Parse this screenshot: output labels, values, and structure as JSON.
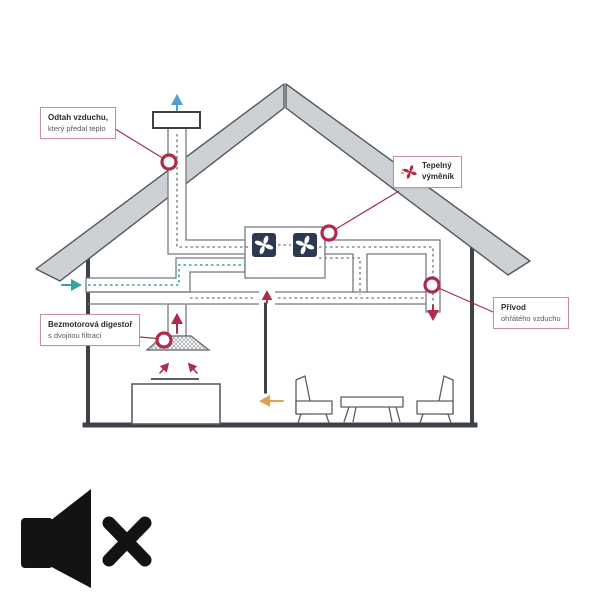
{
  "diagram": {
    "title_semantic": "home-heat-recovery-ventilation-diagram",
    "labels": {
      "exhaust_air": {
        "line1": "Odtah vzduchu,",
        "line2": "který předal teplo"
      },
      "heat_exchanger": {
        "line1": "Tepelný",
        "line2": "výměník"
      },
      "cooker_hood": {
        "line1": "Bezmotorová digestoř",
        "line2": "s dvojitou filtrací"
      },
      "supply_air": {
        "line1": "Přívod",
        "line2": "ohřátého vzduchu"
      }
    },
    "icons": {
      "heat_exchanger_label_icon": "fan-icon",
      "unit_fans": "fan-icon",
      "marker": "circle-marker"
    },
    "airflow": {
      "intake_arrow_color": "#2fa69b",
      "roof_exhaust_arrow_color": "#4f9fd0",
      "warm_supply_arrow_color": "#b02a4a",
      "door_transfer_arrow_color": "#dba44a"
    },
    "colors": {
      "accent_crimson": "#b02a4a",
      "leader_line": "#9e3347",
      "label_border": "#c5909a",
      "roof_fill": "#cdd1d6",
      "structure": "#3d4248",
      "duct_outline": "#75797f",
      "unit_fill": "#2c3950"
    }
  },
  "audio": {
    "state": "muted",
    "icon": "speaker-muted-icon"
  }
}
